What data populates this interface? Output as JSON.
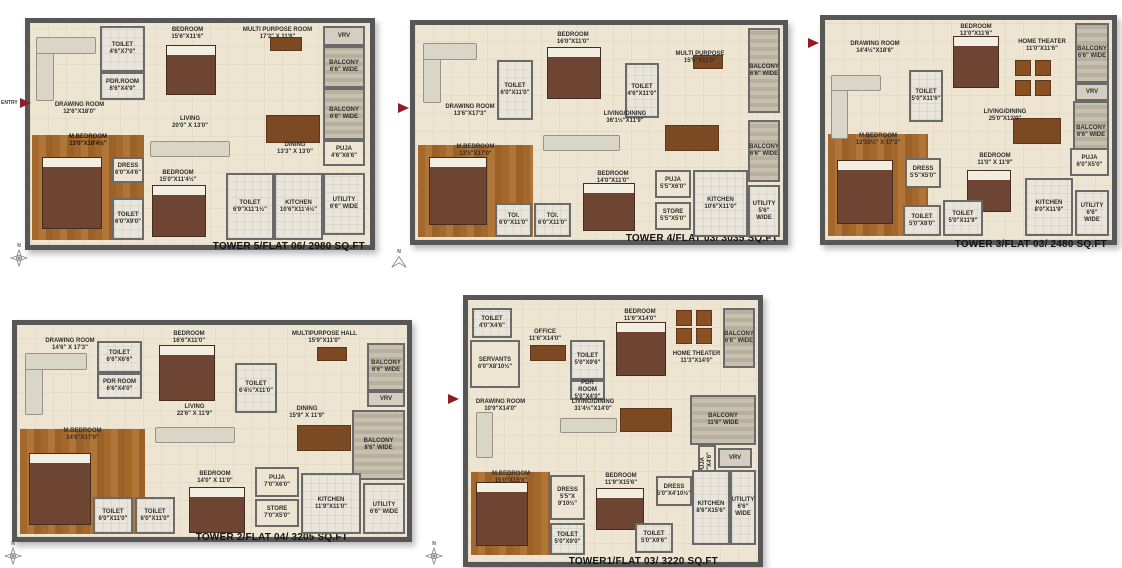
{
  "icons": {
    "compass_label": "N"
  },
  "colors": {
    "wall": "#575757",
    "floor": "#ede5d2",
    "wood": "#a5682c",
    "tile": "#e9e5da",
    "balcony": "#c0b8a6",
    "entry_arrow": "#8f1d22"
  },
  "plans": [
    {
      "title": "TOWER 5/FLAT 06/ 2980 SQ.FT",
      "entry": "ENTRY",
      "rooms": [
        {
          "text": "TOILET\n4'6\"X7'0\""
        },
        {
          "text": "PDR.ROOM\n6'6\"X4'9\""
        },
        {
          "text": "BEDROOM\n15'6\"X11'6\""
        },
        {
          "text": "MULTI PURPOSE ROOM\n17'3\" X 11'6\""
        },
        {
          "text": "VRV"
        },
        {
          "text": "BALCONY\n6'6\" WIDE"
        },
        {
          "text": "DRAWING ROOM\n12'6\"X18'0\""
        },
        {
          "text": "LIVING\n20'0\" X 13'0\""
        },
        {
          "text": "DINING\n13'3\" X 13'0\""
        },
        {
          "text": "BALCONY\n6'6\" WIDE"
        },
        {
          "text": "PUJA\n4'6\"X6'6\""
        },
        {
          "text": "M.BEDROOM\n13'0\"X18'4½\""
        },
        {
          "text": "DRESS\n6'0\"X4'6\""
        },
        {
          "text": "TOILET\n6'0\"X9'0\""
        },
        {
          "text": "BEDROOM\n15'0\"X11'4½\""
        },
        {
          "text": "TOILET\n6'9\"X11'1½\""
        },
        {
          "text": "KITCHEN\n10'6\"X11'4½\""
        },
        {
          "text": "UTILITY\n6'6\" WIDE"
        }
      ]
    },
    {
      "title": "TOWER 4/FLAT 03/ 3035 SQ.FT",
      "rooms": [
        {
          "text": "DRAWING ROOM\n13'6\"X17'3\""
        },
        {
          "text": "TOILET\n6'0\"X11'0\""
        },
        {
          "text": "BEDROOM\n16'0\"X11'0\""
        },
        {
          "text": "TOILET\n4'6\"X11'0\""
        },
        {
          "text": "MULTI PURPOSE\n15'5\"X11'0\""
        },
        {
          "text": "BALCONY\n6'6\" WIDE"
        },
        {
          "text": "LIVING/DINING\n36'1½\"X11'9\""
        },
        {
          "text": "BALCONY\n6'6\" WIDE"
        },
        {
          "text": "M.BEDROOM\n13'5\"X17'0\""
        },
        {
          "text": "TOI.\n6'0\"X11'0\""
        },
        {
          "text": "TOI.\n6'0\"X11'0\""
        },
        {
          "text": "BEDROOM\n14'0\"X11'0\""
        },
        {
          "text": "PUJA\n5'5\"X6'0\""
        },
        {
          "text": "STORE\n5'5\"X5'0\""
        },
        {
          "text": "KITCHEN\n10'6\"X11'0\""
        },
        {
          "text": "UTILITY\n5'6\" WIDE"
        }
      ]
    },
    {
      "title": "TOWER 3/FLAT 03/ 2480 SQ.FT",
      "rooms": [
        {
          "text": "DRAWING ROOM\n14'4½\"X18'6\""
        },
        {
          "text": "BEDROOM\n12'0\"X11'6\""
        },
        {
          "text": "TOILET\n5'0\"X11'6\""
        },
        {
          "text": "HOME THEATER\n11'0\"X11'6\""
        },
        {
          "text": "BALCONY\n6'6\" WIDE"
        },
        {
          "text": "VRV"
        },
        {
          "text": "BALCONY\n6'6\" WIDE"
        },
        {
          "text": "LIVING/DINING\n25'0\"X12'0\""
        },
        {
          "text": "M BEDROOM\n12'10½\" X 17'3\""
        },
        {
          "text": "DRESS\n5'5\"X5'0\""
        },
        {
          "text": "BEDROOM\n11'0\" X 11'9\""
        },
        {
          "text": "PUJA\n6'0\"X5'0\""
        },
        {
          "text": "KITCHEN\n8'0\"X11'9\""
        },
        {
          "text": "UTILITY\n6'6\" WIDE"
        },
        {
          "text": "TOILET\n5'0\"X8'0\""
        },
        {
          "text": "TOILET\n5'0\"X11'9\""
        }
      ]
    },
    {
      "title": "TOWER 2/FLAT 04/ 3205 SQ.FT",
      "rooms": [
        {
          "text": "DRAWING ROOM\n14'6\" X 17'3\""
        },
        {
          "text": "TOILET\n6'6\"X6'6\""
        },
        {
          "text": "PDR ROOM\n6'6\"X4'0\""
        },
        {
          "text": "BEDROOM\n16'6\"X11'0\""
        },
        {
          "text": "TOILET\n6'4½\"X11'0\""
        },
        {
          "text": "MULTIPURPOSE HALL\n15'9\"X11'0\""
        },
        {
          "text": "BALCONY\n6'6\" WIDE"
        },
        {
          "text": "VRV"
        },
        {
          "text": "BALCONY\n8'6\" WIDE"
        },
        {
          "text": "LIVING\n22'6\" X 11'9\""
        },
        {
          "text": "DINING\n15'9\" X 11'9\""
        },
        {
          "text": "M.BEDROOM\n14'6\"X17'0\""
        },
        {
          "text": "TOILET\n6'0\"X11'0\""
        },
        {
          "text": "TOILET\n6'0\"X11'0\""
        },
        {
          "text": "BEDROOM\n14'0\" X 11'0\""
        },
        {
          "text": "PUJA\n7'0\"X6'0\""
        },
        {
          "text": "STORE\n7'0\"X5'0\""
        },
        {
          "text": "KITCHEN\n11'9\"X11'0\""
        },
        {
          "text": "UTILITY\n6'6\" WIDE"
        }
      ]
    },
    {
      "title": "TOWER1/FLAT 03/ 3220 SQ.FT",
      "rooms": [
        {
          "text": "TOILET\n4'0\"X4'6\""
        },
        {
          "text": "SERVANTS\n6'0\"X8'10½\""
        },
        {
          "text": "OFFICE\n11'6\"X14'0\""
        },
        {
          "text": "TOILET\n5'0\"X9'6\""
        },
        {
          "text": "PDR ROOM\n5'0\"X4'0\""
        },
        {
          "text": "BEDROOM\n11'6\"X14'0\""
        },
        {
          "text": "HOME THEATER\n11'3\"X14'0\""
        },
        {
          "text": "BALCONY\n6'6\" WIDE"
        },
        {
          "text": "DRAWING ROOM\n10'9\"X14'0\""
        },
        {
          "text": "LIVING/DINING\n31'4½\"X14'0\""
        },
        {
          "text": "BALCONY\n11'6\" WIDE"
        },
        {
          "text": "PUJA\n5'0\"X4'6\""
        },
        {
          "text": "VRV"
        },
        {
          "text": "M.BEDROOM\n15'0\"X15'6\""
        },
        {
          "text": "DRESS\n5'5\"X 9'10½\""
        },
        {
          "text": "BEDROOM\n11'9\"X15'6\""
        },
        {
          "text": "DRESS\n5'0\"X4'10½\""
        },
        {
          "text": "KITCHEN\n8'6\"X15'6\""
        },
        {
          "text": "UTILITY\n6'6\" WIDE"
        },
        {
          "text": "TOILET\n5'0\"X9'0\""
        },
        {
          "text": "TOILET\n5'0\"X9'6\""
        }
      ]
    }
  ]
}
